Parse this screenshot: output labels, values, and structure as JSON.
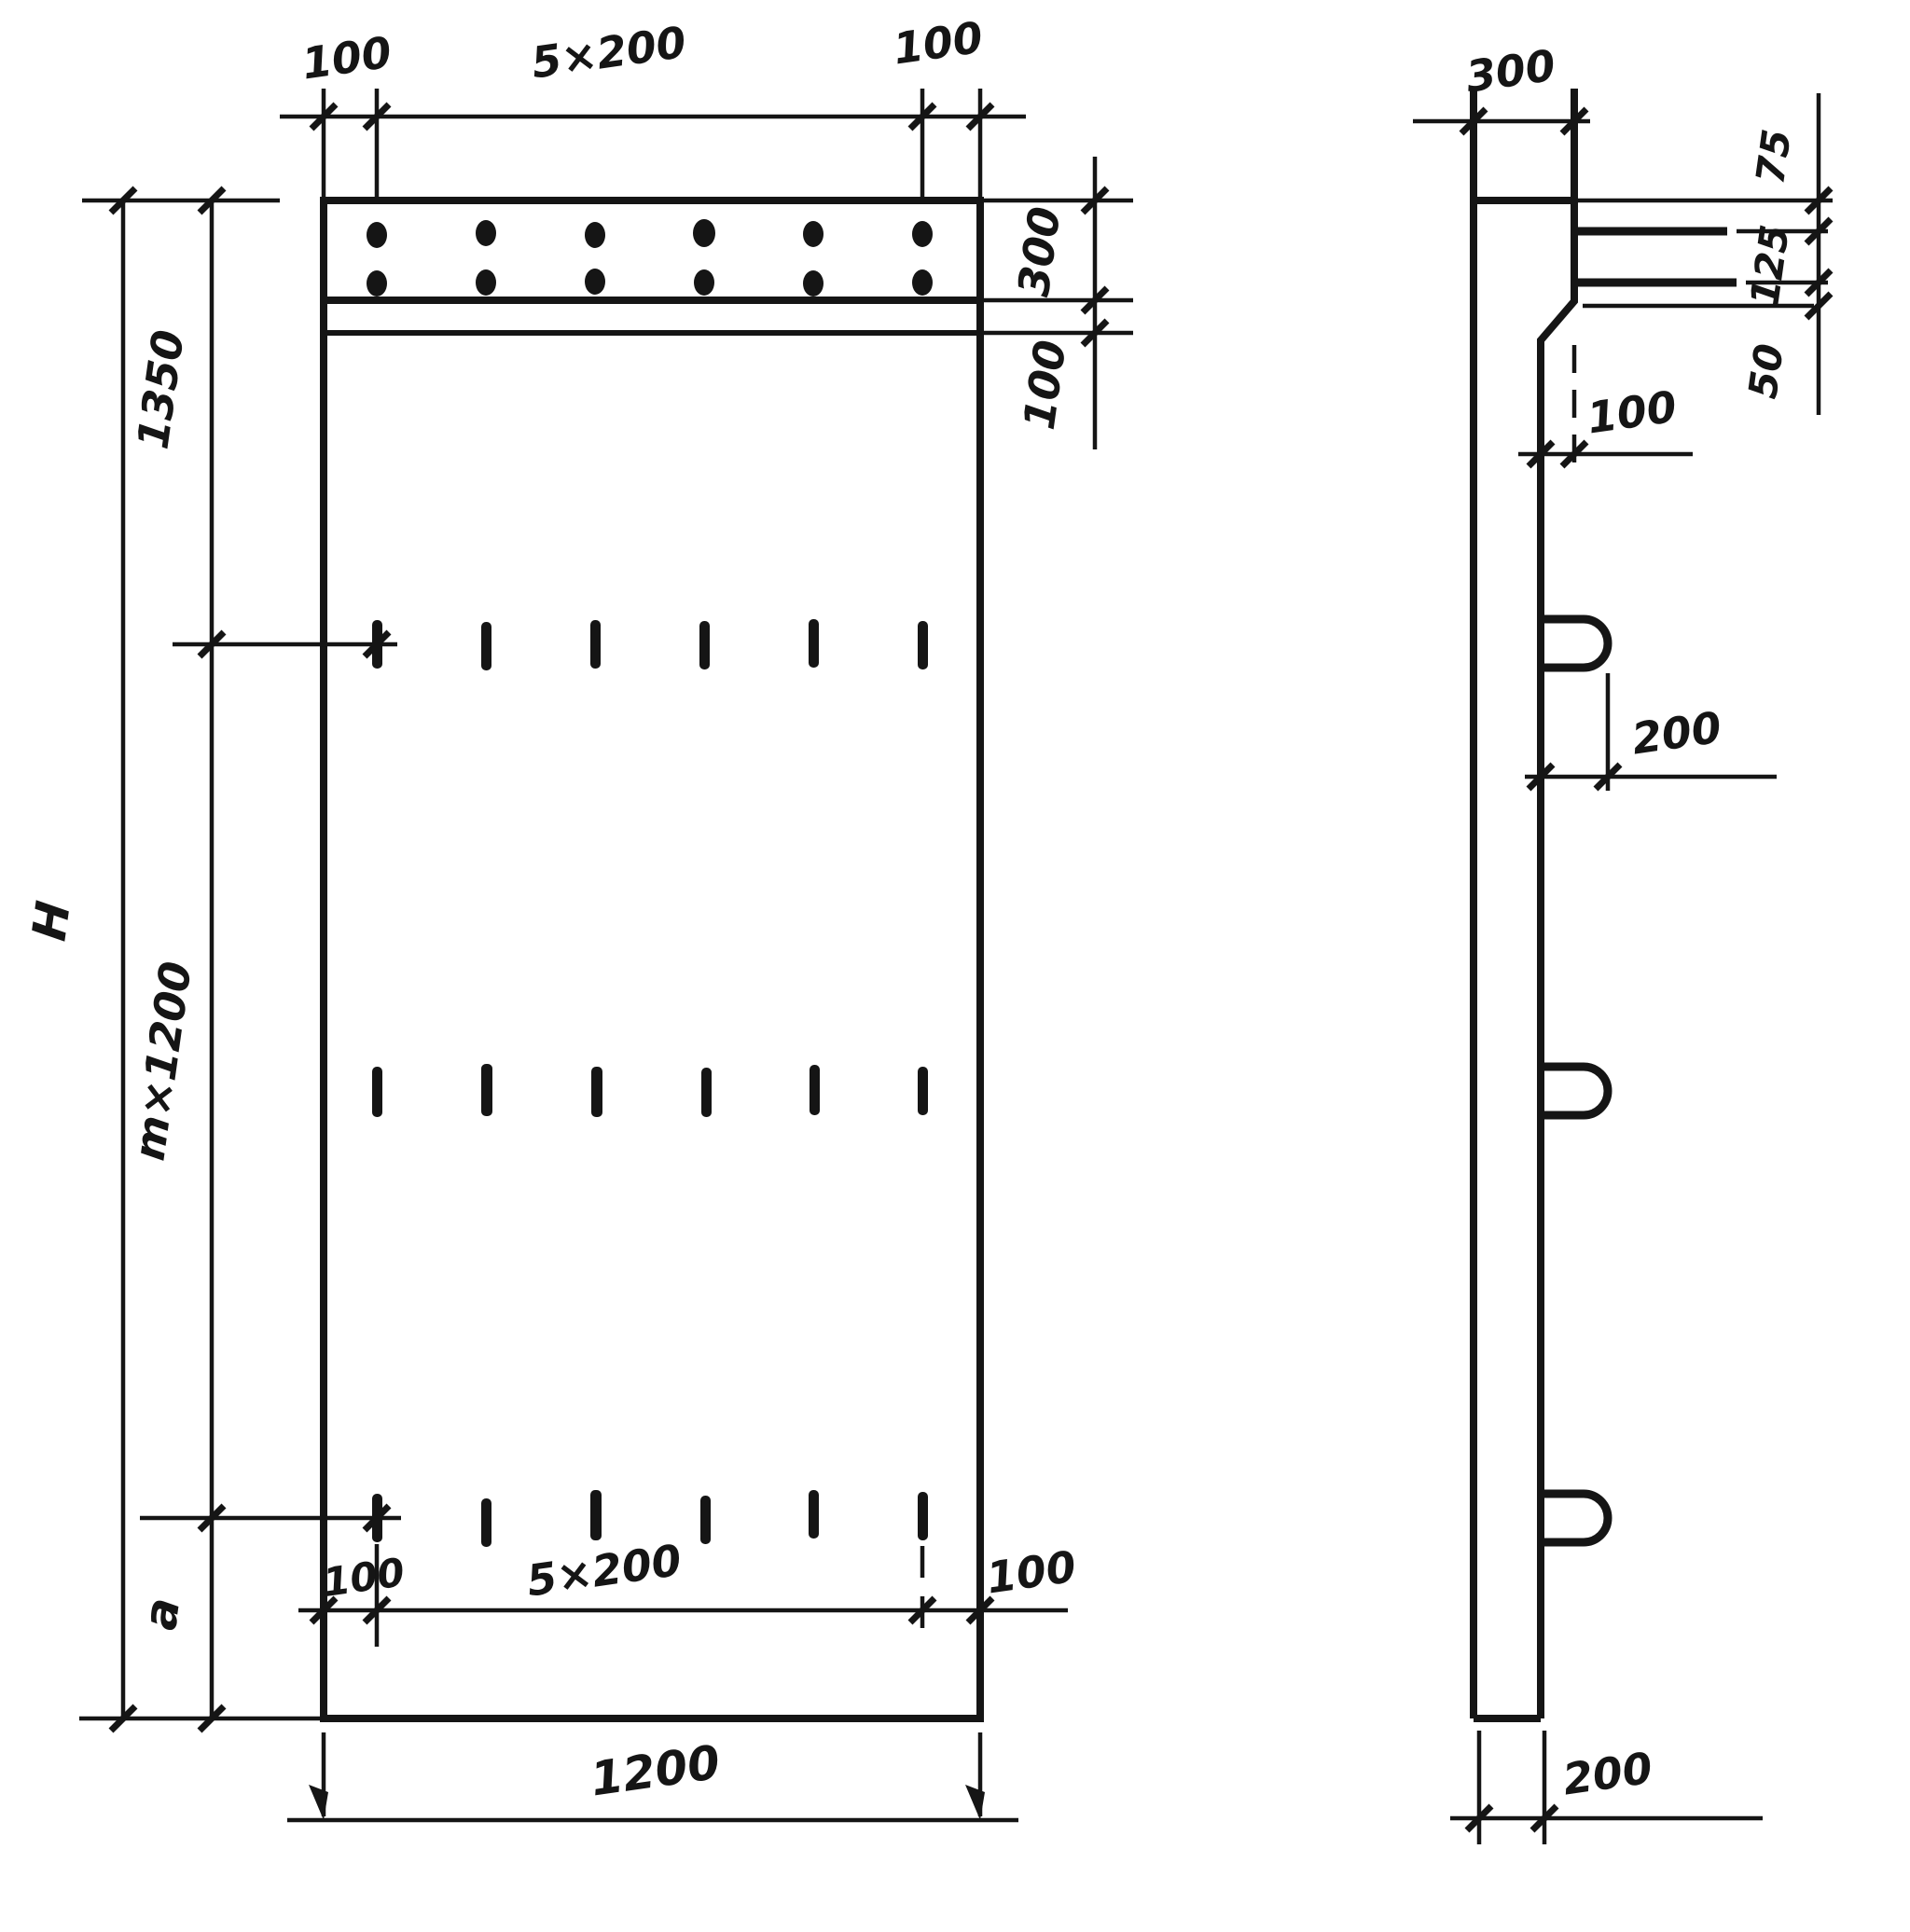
{
  "drawing": {
    "kind": "technical-drawing",
    "description": "Dimensioned front view and side view of a precast reinforced concrete panel with top anchor band, three rows of slots and lifting loops",
    "colors": {
      "ink": "#151515",
      "paper": "#ffffff"
    }
  },
  "front_view": {
    "top_dims": {
      "left": "100",
      "middle": "5×200",
      "right": "100"
    },
    "right_dims": {
      "band": "300",
      "strip": "100"
    },
    "left_dims": {
      "top": "1350",
      "overall": "H",
      "middle": "m×1200",
      "bottom": "a"
    },
    "bottom_inner_dims": {
      "left": "100",
      "middle": "5×200",
      "right": "100"
    },
    "bottom_dim": "1200",
    "anchor_dots": {
      "rows": 2,
      "columns": 6
    },
    "slot_rows": {
      "rows": 3,
      "slots_per_row": 6
    }
  },
  "side_view": {
    "top_dim": "300",
    "right_dims": {
      "top": "75",
      "middle": "125",
      "bottom": "50"
    },
    "step_dim": "100",
    "loop_dim": "200",
    "bottom_dim": "200",
    "loops": 3,
    "dowel_bars": 2
  }
}
